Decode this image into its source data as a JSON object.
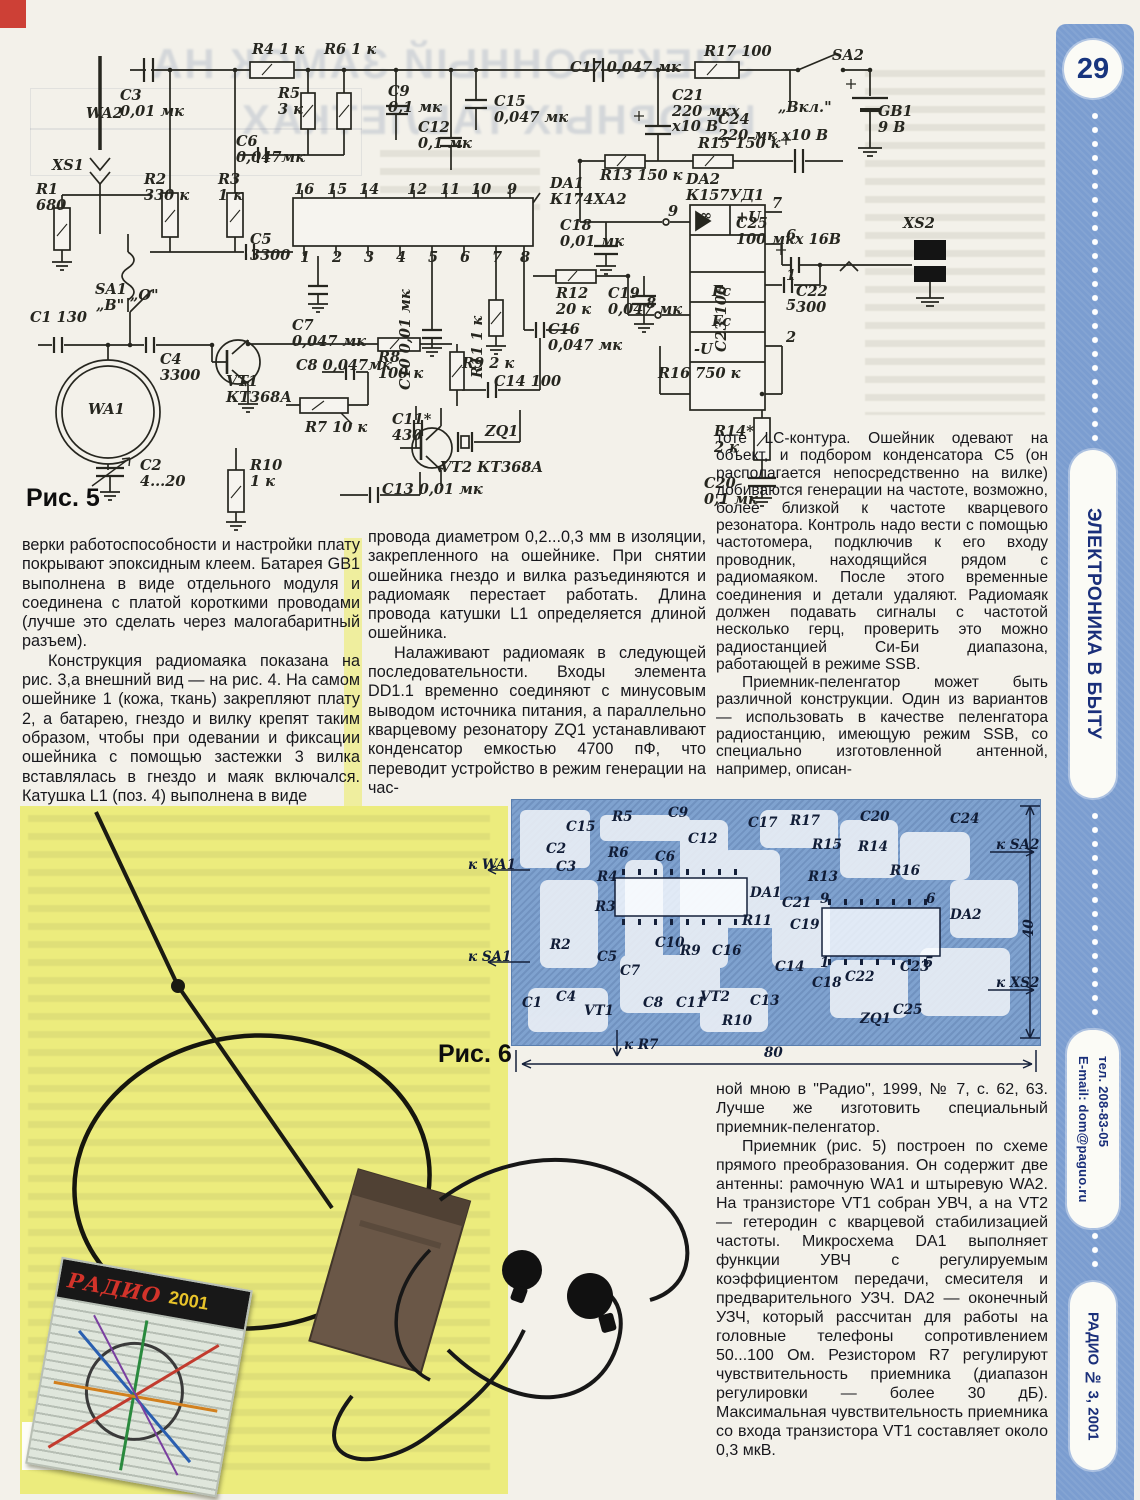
{
  "page": {
    "number": "29",
    "section": "ЭЛЕКТРОНИКА В БЫТУ",
    "email": "E-mail: dom@paguo.ru",
    "phone": "тел. 208-83-05",
    "issue": "РАДИО № 3, 2001"
  },
  "bleed": {
    "title_l1": "ЭЛЕКТРОННЫЙ ЗАМОК НА",
    "title_l2": "ИБОРНЫХ ТАБЛЕТКАХ"
  },
  "figures": {
    "fig5_caption": "Рис. 5",
    "fig6_caption": "Рис. 6",
    "fig7_caption": "Рис. 7"
  },
  "photo": {
    "card_brand": "РАДИО",
    "card_year": "2001"
  },
  "columns": {
    "left": [
      {
        "indent": false,
        "text": "верки работоспособности и настройки плату покрывают эпоксидным клеем. Батарея GB1 выполнена в виде отдельного модуля и соединена с платой короткими проводами (лучше это сделать через малогабаритный разъем)."
      },
      {
        "indent": true,
        "text": "Конструкция радиомаяка показана на рис. 3,а внешний вид — на рис. 4. На самом ошейнике 1 (кожа, ткань) закрепляют плату 2, а батарею, гнездо и вилку крепят таким образом, чтобы при одевании и фиксации ошейника с помощью застежки 3 вилка вставлялась в гнездо и маяк включался. Катушка L1 (поз. 4) выполнена в виде"
      }
    ],
    "middle": [
      {
        "indent": false,
        "text": "провода диаметром 0,2...0,3 мм в изоляции, закрепленного на ошейнике. При снятии ошейника гнездо и вилка разъединяются и радиомаяк перестает работать. Длина провода катушки L1 определяется длиной ошейника."
      },
      {
        "indent": true,
        "text": "Налаживают радиомаяк в следующей последовательности. Входы элемента DD1.1 временно соединяют с минусовым выводом источника питания, а параллельно кварцевому резонатору ZQ1 устанавливают конденсатор емкостью 4700 пФ, что переводит устройство в режим генерации на час-"
      }
    ],
    "right": [
      {
        "indent": false,
        "text": "тоте LC-контура. Ошейник одевают на объект, и подбором конденсатора C5 (он располагается непосредственно на вилке) добиваются генерации на частоте, возможно, более близкой к частоте кварцевого резонатора. Контроль надо вести с помощью частотомера, подключив к его входу проводник, находящийся рядом с радиомаяком. После этого временные соединения и детали удаляют. Радиомаяк должен подавать сигналы с частотой несколько герц, проверить это можно радиостанцией Си-Би диапазона, работающей в режиме SSB."
      },
      {
        "indent": true,
        "text": "Приемник-пеленгатор может быть различной конструкции. Один из вариантов — использовать в качестве пеленгатора радиостанцию, имеющую режим SSB, со специально изготовленной антенной, например, описан-"
      }
    ],
    "bottom_right": [
      {
        "indent": false,
        "text": "ной мною в \"Радио\", 1999, № 7, с. 62, 63. Лучше же изготовить специальный приемник-пеленгатор."
      },
      {
        "indent": true,
        "text": "Приемник (рис. 5) построен по схеме прямого преобразования. Он содержит две антенны: рамочную WA1 и штыревую WA2. На транзисторе VT1 собран УВЧ, а на VT2 — гетеродин с кварцевой стабилизацией частоты. Микросхема DA1 выполняет функции УВЧ с регулируемым коэффициентом передачи, смесителя и предварительного УЗЧ. DA2 — оконечный УЗЧ, который рассчитан для работы на головные телефоны сопротивлением 50...100 Ом. Резистором R7 регулируют чувствительность приемника (диапазон регулировки — более 30 дБ). Максимальная чувствительность приемника со входа транзистора VT1 составляет около 0,3 мкВ."
      }
    ]
  },
  "fig5_labels": [
    {
      "t": "WA2",
      "x": 86,
      "y": 106
    },
    {
      "t": "XS1",
      "x": 52,
      "y": 158
    },
    {
      "t": "R1\n680",
      "x": 36,
      "y": 182
    },
    {
      "t": "C3\n0,01 мк",
      "x": 120,
      "y": 88
    },
    {
      "t": "R2\n330 к",
      "x": 144,
      "y": 172
    },
    {
      "t": "R3\n1 к",
      "x": 218,
      "y": 172
    },
    {
      "t": "C6\n0,047мк",
      "x": 236,
      "y": 134
    },
    {
      "t": "R4 1 к",
      "x": 252,
      "y": 42
    },
    {
      "t": "R5\n3 к",
      "x": 278,
      "y": 86
    },
    {
      "t": "R6 1 к",
      "x": 324,
      "y": 42
    },
    {
      "t": "C9\n0,1 мк",
      "x": 388,
      "y": 84
    },
    {
      "t": "C12\n0,1 мк",
      "x": 418,
      "y": 120
    },
    {
      "t": "C15\n0,047 мк",
      "x": 494,
      "y": 94
    },
    {
      "t": "C17 0,047 мк",
      "x": 570,
      "y": 60
    },
    {
      "t": "C21\n220 мкх\nх10 В",
      "x": 672,
      "y": 88
    },
    {
      "t": "R17 100",
      "x": 704,
      "y": 44
    },
    {
      "t": "SA2",
      "x": 832,
      "y": 48
    },
    {
      "t": "„Вкл.\"",
      "x": 778,
      "y": 100
    },
    {
      "t": "C24\n220 мк х10 В",
      "x": 718,
      "y": 112
    },
    {
      "t": "GB1\n9 В",
      "x": 878,
      "y": 104
    },
    {
      "t": "R15 150 к",
      "x": 698,
      "y": 136
    },
    {
      "t": "R13 150 к",
      "x": 600,
      "y": 168
    },
    {
      "t": "DA1\nК174ХА2",
      "x": 550,
      "y": 176
    },
    {
      "t": "DA2\nК157УД1",
      "x": 686,
      "y": 172
    },
    {
      "t": "C18\n0,01 мк",
      "x": 560,
      "y": 218
    },
    {
      "t": "C25\n100 мкх 16В",
      "x": 736,
      "y": 216
    },
    {
      "t": "XS2",
      "x": 903,
      "y": 216
    },
    {
      "t": "C22\n300",
      "x": 796,
      "y": 284
    },
    {
      "t": "C23 100",
      "x": 714,
      "y": 352,
      "r": 1
    },
    {
      "t": "R16 750 к",
      "x": 658,
      "y": 366
    },
    {
      "t": "R14*\n2 к",
      "x": 714,
      "y": 424
    },
    {
      "t": "C20\n0,1 мк",
      "x": 704,
      "y": 476
    },
    {
      "t": "C5\n3300",
      "x": 250,
      "y": 232
    },
    {
      "t": "C7\n0,047 мк",
      "x": 292,
      "y": 318
    },
    {
      "t": "C10 0,01 мк",
      "x": 398,
      "y": 390,
      "r": 1
    },
    {
      "t": "R11 1 к",
      "x": 470,
      "y": 378,
      "r": 1
    },
    {
      "t": "C16\n0,047 мк",
      "x": 548,
      "y": 322
    },
    {
      "t": "R12\n20 к",
      "x": 556,
      "y": 286
    },
    {
      "t": "C19\n0,047 мк",
      "x": 608,
      "y": 286
    },
    {
      "t": "R8\n100 к",
      "x": 378,
      "y": 350
    },
    {
      "t": "C8 0,047мк",
      "x": 296,
      "y": 358
    },
    {
      "t": "R9 2 к",
      "x": 462,
      "y": 356
    },
    {
      "t": "C14 100",
      "x": 494,
      "y": 374
    },
    {
      "t": "C11*\n430",
      "x": 392,
      "y": 412
    },
    {
      "t": "R7 10 к",
      "x": 305,
      "y": 420
    },
    {
      "t": "VT1\nКТ368А",
      "x": 226,
      "y": 374
    },
    {
      "t": "SA1",
      "x": 95,
      "y": 282
    },
    {
      "t": "„В\"",
      "x": 96,
      "y": 298
    },
    {
      "t": "„О\"",
      "x": 130,
      "y": 288
    },
    {
      "t": "C1 130",
      "x": 30,
      "y": 310
    },
    {
      "t": "C4\n3300",
      "x": 160,
      "y": 352
    },
    {
      "t": "WA1",
      "x": 88,
      "y": 402
    },
    {
      "t": "C2\n4...20",
      "x": 140,
      "y": 458
    },
    {
      "t": "R10\n1 к",
      "x": 250,
      "y": 458
    },
    {
      "t": "VT2 КТ368А",
      "x": 440,
      "y": 460
    },
    {
      "t": "ZQ1",
      "x": 485,
      "y": 424
    },
    {
      "t": "C13 0,01 мк",
      "x": 382,
      "y": 482
    },
    {
      "t": "∞",
      "x": 700,
      "y": 208
    },
    {
      "t": "+U",
      "x": 736,
      "y": 210
    },
    {
      "t": "Fc",
      "x": 712,
      "y": 284
    },
    {
      "t": "Fc",
      "x": 712,
      "y": 314
    },
    {
      "t": "-U",
      "x": 694,
      "y": 342
    },
    {
      "t": "9",
      "x": 668,
      "y": 204
    },
    {
      "t": "8",
      "x": 646,
      "y": 296
    },
    {
      "t": "7",
      "x": 772,
      "y": 196
    },
    {
      "t": "6",
      "x": 786,
      "y": 228
    },
    {
      "t": "1",
      "x": 786,
      "y": 268
    },
    {
      "t": "5",
      "x": 786,
      "y": 298
    },
    {
      "t": "2",
      "x": 786,
      "y": 330
    },
    {
      "t": "16",
      "x": 294,
      "y": 182
    },
    {
      "t": "15",
      "x": 327,
      "y": 182
    },
    {
      "t": "14",
      "x": 359,
      "y": 182
    },
    {
      "t": "12",
      "x": 407,
      "y": 182
    },
    {
      "t": "11",
      "x": 440,
      "y": 182
    },
    {
      "t": "10",
      "x": 471,
      "y": 182
    },
    {
      "t": "9",
      "x": 507,
      "y": 182
    },
    {
      "t": "1",
      "x": 300,
      "y": 250
    },
    {
      "t": "2",
      "x": 332,
      "y": 250
    },
    {
      "t": "3",
      "x": 364,
      "y": 250
    },
    {
      "t": "4",
      "x": 396,
      "y": 250
    },
    {
      "t": "5",
      "x": 428,
      "y": 250
    },
    {
      "t": "6",
      "x": 460,
      "y": 250
    },
    {
      "t": "7",
      "x": 492,
      "y": 250
    },
    {
      "t": "8",
      "x": 520,
      "y": 250
    }
  ],
  "fig6_labels": [
    {
      "t": "C2",
      "x": 546,
      "y": 842
    },
    {
      "t": "C15",
      "x": 566,
      "y": 820
    },
    {
      "t": "R5",
      "x": 612,
      "y": 810
    },
    {
      "t": "C9",
      "x": 668,
      "y": 806
    },
    {
      "t": "C12",
      "x": 688,
      "y": 832
    },
    {
      "t": "C6",
      "x": 655,
      "y": 850
    },
    {
      "t": "R6",
      "x": 608,
      "y": 846
    },
    {
      "t": "C3",
      "x": 556,
      "y": 860
    },
    {
      "t": "R4",
      "x": 597,
      "y": 870
    },
    {
      "t": "R3",
      "x": 595,
      "y": 900
    },
    {
      "t": "R2",
      "x": 550,
      "y": 938
    },
    {
      "t": "C5",
      "x": 597,
      "y": 950
    },
    {
      "t": "C10",
      "x": 655,
      "y": 936
    },
    {
      "t": "C7",
      "x": 620,
      "y": 964
    },
    {
      "t": "C1",
      "x": 522,
      "y": 996
    },
    {
      "t": "C4",
      "x": 556,
      "y": 990
    },
    {
      "t": "VT1",
      "x": 584,
      "y": 1004
    },
    {
      "t": "C8",
      "x": 643,
      "y": 996
    },
    {
      "t": "C11",
      "x": 676,
      "y": 996
    },
    {
      "t": "R9",
      "x": 680,
      "y": 944
    },
    {
      "t": "C16",
      "x": 712,
      "y": 944
    },
    {
      "t": "VT2",
      "x": 700,
      "y": 990
    },
    {
      "t": "R10",
      "x": 722,
      "y": 1014
    },
    {
      "t": "DA1",
      "x": 750,
      "y": 886
    },
    {
      "t": "R11",
      "x": 742,
      "y": 914
    },
    {
      "t": "C13",
      "x": 750,
      "y": 994
    },
    {
      "t": "C17",
      "x": 748,
      "y": 816
    },
    {
      "t": "R17",
      "x": 790,
      "y": 814
    },
    {
      "t": "R15",
      "x": 812,
      "y": 838
    },
    {
      "t": "R13",
      "x": 808,
      "y": 870
    },
    {
      "t": "C21",
      "x": 782,
      "y": 896
    },
    {
      "t": "C19",
      "x": 790,
      "y": 918
    },
    {
      "t": "C14",
      "x": 775,
      "y": 960
    },
    {
      "t": "C18",
      "x": 812,
      "y": 976
    },
    {
      "t": "C22",
      "x": 845,
      "y": 970
    },
    {
      "t": "C23",
      "x": 900,
      "y": 960
    },
    {
      "t": "C25",
      "x": 893,
      "y": 1003
    },
    {
      "t": "ZQ1",
      "x": 860,
      "y": 1012
    },
    {
      "t": "C20",
      "x": 860,
      "y": 810
    },
    {
      "t": "R14",
      "x": 858,
      "y": 840
    },
    {
      "t": "R16",
      "x": 890,
      "y": 864
    },
    {
      "t": "C24",
      "x": 950,
      "y": 812
    },
    {
      "t": "DA2",
      "x": 950,
      "y": 908
    },
    {
      "t": "9",
      "x": 820,
      "y": 892
    },
    {
      "t": "6",
      "x": 926,
      "y": 892
    },
    {
      "t": "1",
      "x": 820,
      "y": 956
    },
    {
      "t": "5",
      "x": 924,
      "y": 956
    },
    {
      "t": "к WA1",
      "x": 468,
      "y": 858
    },
    {
      "t": "к SA1",
      "x": 468,
      "y": 950
    },
    {
      "t": "к SA2",
      "x": 996,
      "y": 838
    },
    {
      "t": "к XS2",
      "x": 996,
      "y": 976
    },
    {
      "t": "к R7",
      "x": 624,
      "y": 1038
    },
    {
      "t": "80",
      "x": 764,
      "y": 1046
    },
    {
      "t": "40",
      "x": 1022,
      "y": 938,
      "r": 1
    }
  ]
}
